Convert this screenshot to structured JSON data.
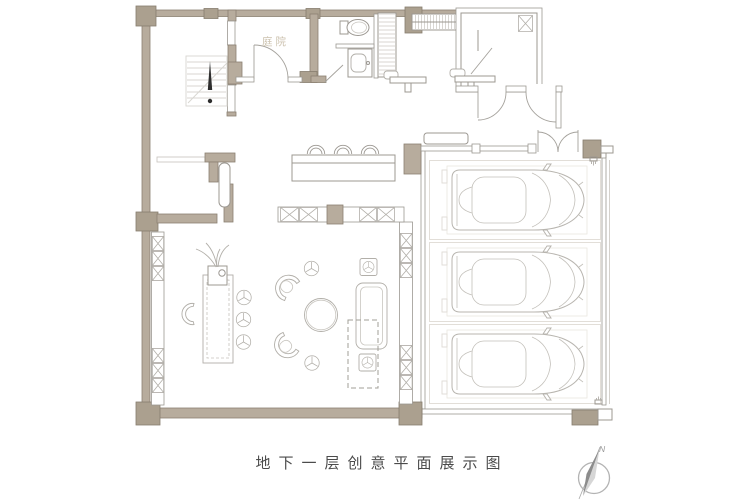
{
  "title": "地下一层创意平面展示图",
  "labels": {
    "courtyard": "庭院",
    "compass_north": "N"
  },
  "colors": {
    "wall_fill": "#b7ac9d",
    "wall_block": "#aba08f",
    "wall_outline": "#8b8172",
    "thin_wall_line": "#9c9892",
    "furniture_line": "#b2afa9",
    "parking_line": "#dfdbd4",
    "car_line": "#b8b5af",
    "stair_line": "#d8d6d1",
    "arrow_color": "#2e2e2e",
    "title_text": "#4b4b4b",
    "courtyard_label_text": "#cdc3b0",
    "background": "#ffffff"
  },
  "counts": {
    "parking_stalls": 3,
    "cars": 3,
    "bar_stools": 3,
    "table_stools": 3,
    "armchairs": 2,
    "tripod_stools": 2,
    "side_tables": 2,
    "desks": 2
  }
}
